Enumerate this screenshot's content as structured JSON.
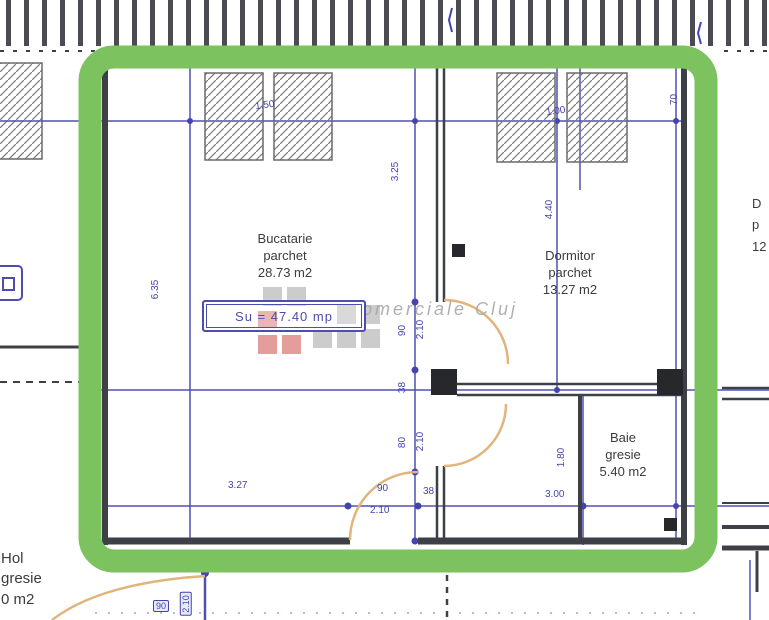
{
  "rooms": {
    "bucatarie": {
      "name": "Bucatarie",
      "finish": "parchet",
      "area": "28.73 m2"
    },
    "dormitor": {
      "name": "Dormitor",
      "finish": "parchet",
      "area": "13.27 m2"
    },
    "baie": {
      "name": "Baie",
      "finish": "gresie",
      "area": "5.40 m2"
    },
    "hol": {
      "name": "Hol",
      "finish": "gresie",
      "area": "0 m2"
    },
    "neighbor_cut": {
      "line1": "D",
      "line2": "p",
      "line3": "12"
    }
  },
  "labels": {
    "usable_area": "Su = 47.40 mp"
  },
  "watermark": {
    "text": "omerciale Cluj"
  },
  "dimension_labels": [
    {
      "v": "1.50",
      "x": 255,
      "y": 100,
      "rot": -8
    },
    {
      "v": "1.00",
      "x": 546,
      "y": 106,
      "rot": -8
    },
    {
      "v": "70",
      "x": 669,
      "y": 94,
      "rot": -90
    },
    {
      "v": "3.25",
      "x": 386,
      "y": 166,
      "rot": -90
    },
    {
      "v": "4.40",
      "x": 540,
      "y": 204,
      "rot": -90
    },
    {
      "v": "6.35",
      "x": 146,
      "y": 284,
      "rot": -90
    },
    {
      "v": "90",
      "x": 397,
      "y": 325,
      "rot": -90
    },
    {
      "v": "2.10",
      "x": 411,
      "y": 324,
      "rot": -90
    },
    {
      "v": "38",
      "x": 397,
      "y": 382,
      "rot": -90
    },
    {
      "v": "80",
      "x": 397,
      "y": 437,
      "rot": -90
    },
    {
      "v": "2.10",
      "x": 411,
      "y": 436,
      "rot": -90
    },
    {
      "v": "3.27",
      "x": 228,
      "y": 480,
      "rot": 0
    },
    {
      "v": "90",
      "x": 377,
      "y": 483,
      "rot": 0
    },
    {
      "v": "2.10",
      "x": 370,
      "y": 505,
      "rot": 0
    },
    {
      "v": "38",
      "x": 423,
      "y": 486,
      "rot": 0
    },
    {
      "v": "3.00",
      "x": 545,
      "y": 489,
      "rot": 0
    },
    {
      "v": "1.80",
      "x": 552,
      "y": 452,
      "rot": -90
    },
    {
      "v": "90",
      "x": 153,
      "y": 600,
      "rot": 0,
      "boxed": true
    },
    {
      "v": "2.10",
      "x": 174,
      "y": 598,
      "rot": -90,
      "boxed": true
    }
  ],
  "colors": {
    "highlight_green": "#7cc25f",
    "dimension_blue": "#4444ae",
    "wall_dark": "#3d4046",
    "door_arc_tan": "#e0b47c",
    "watermark_red": "#c9403c",
    "watermark_gray": "#9b9b9b"
  }
}
